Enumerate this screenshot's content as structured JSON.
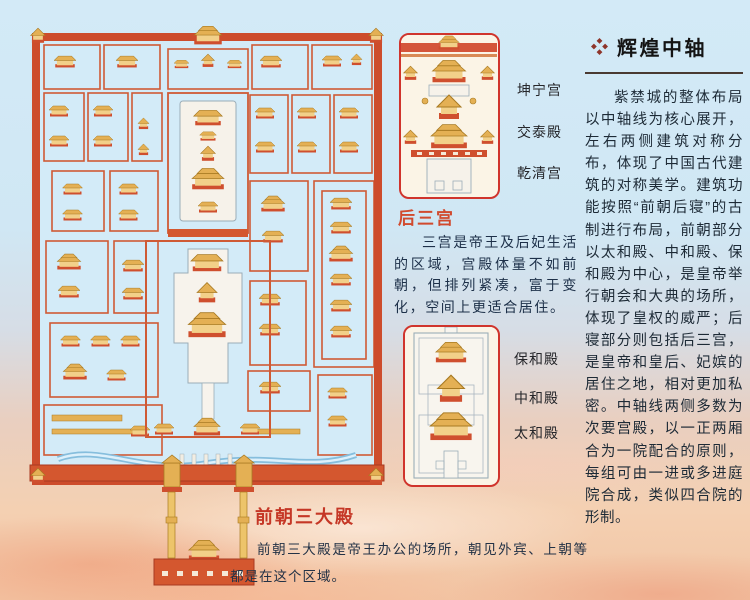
{
  "rear_palaces_panel": {
    "labels": [
      "坤宁宫",
      "交泰殿",
      "乾清宫"
    ],
    "title": "后三宫",
    "description": "三宫是帝王及后妃生活的区域，宫殿体量不如前朝，但排列紧凑，富于变化，空间上更适合居住。"
  },
  "front_halls_panel": {
    "labels": [
      "保和殿",
      "中和殿",
      "太和殿"
    ]
  },
  "front_halls_section": {
    "title": "前朝三大殿",
    "description": "前朝三大殿是帝王办公的场所，朝见外宾、上朝等都是在这个区域。"
  },
  "sidebar": {
    "icon": "diamond-cluster-bullet",
    "title": "辉煌中轴",
    "body": "紫禁城的整体布局以中轴线为核心展开，左右两侧建筑对称分布，体现了中国古代建筑的对称美学。建筑功能按照“前朝后寝”的古制进行布局，前朝部分以太和殿、中和殿、保和殿为中心，是皇帝举行朝会和大典的场所，体现了皇权的威严；后寝部分则包括后三宫，是皇帝和皇后、妃嫔的居住之地，相对更加私密。中轴线两侧多数为次要宫殿，以一正两厢合为一院配合的原则，每组可由一进或多进庭院合成，类似四合院的形制。"
  },
  "colors": {
    "accent_red": "#d0342c",
    "wall_red": "#cd4c2c",
    "roof_gold": "#e4b054",
    "terrace_white": "#f6f2ea",
    "sky_blue": "#d3eaf7",
    "sunset_orange": "#f2c5a4",
    "section_title_red": "#c53726",
    "diamond_red": "#8e352a",
    "body_text": "#1d2a36"
  }
}
